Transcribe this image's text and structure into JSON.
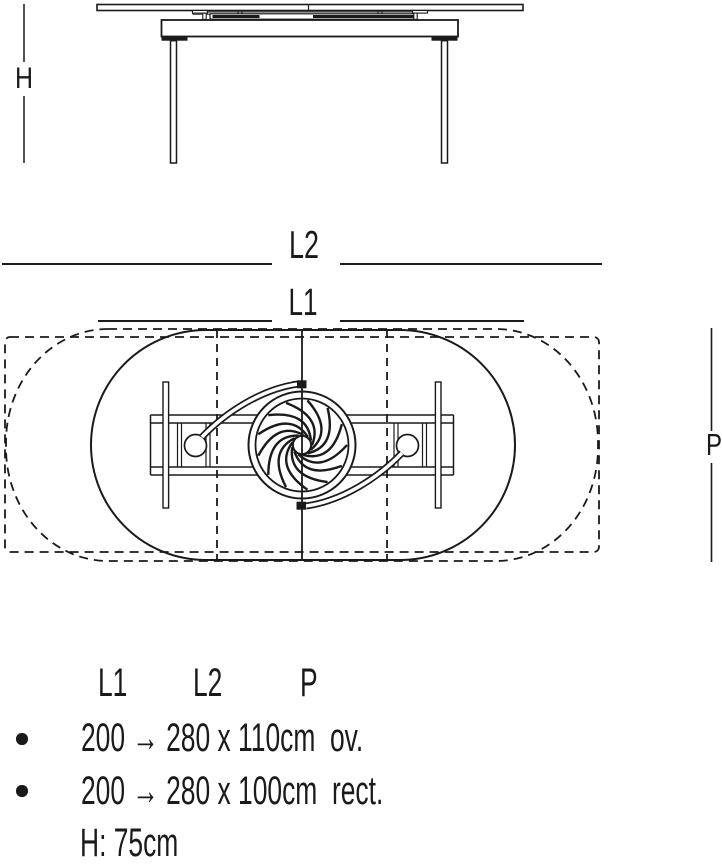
{
  "drawing": {
    "height_label": "H",
    "extended_length_label": "L2",
    "closed_length_label": "L1",
    "depth_label": "P"
  },
  "specs": {
    "columns": {
      "l1": "L1",
      "l2": "L2",
      "p": "P"
    },
    "rows": [
      {
        "text": "200 → 280 x 110cm  ov."
      },
      {
        "text": "200 → 280 x 100cm  rect."
      }
    ],
    "height_note": "H: 75cm"
  },
  "icons": {
    "bullet": "filled-circle"
  },
  "colors": {
    "ink": "#1a1a1a",
    "background": "#ffffff"
  }
}
